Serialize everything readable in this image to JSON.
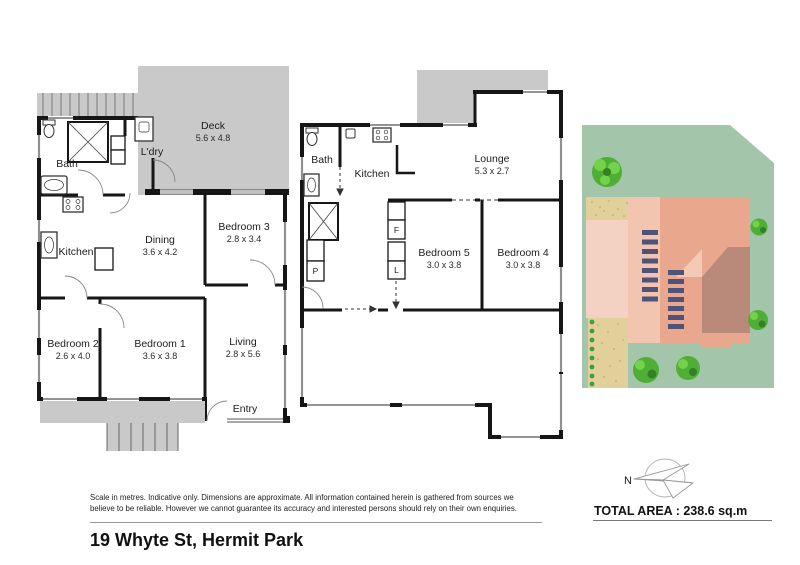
{
  "page": {
    "address": "19 Whyte St, Hermit Park",
    "disclaimer_line1": "Scale in metres. Indicative only. Dimensions are approximate. All information contained herein is gathered from sources we",
    "disclaimer_line2": "believe to be reliable. However we cannot guarantee its accuracy and interested persons should rely on their own enquiries.",
    "total_area": "TOTAL AREA : 238.6 sq.m",
    "compass": {
      "north_label": "N"
    }
  },
  "plan1": {
    "rooms": [
      {
        "name": "Deck",
        "dims": "5.6 x 4.8"
      },
      {
        "name": "Bath"
      },
      {
        "name": "L'dry"
      },
      {
        "name": "Kitchen"
      },
      {
        "name": "Dining",
        "dims": "3.6 x 4.2"
      },
      {
        "name": "Bedroom 3",
        "dims": "2.8 x 3.4"
      },
      {
        "name": "Bedroom 2",
        "dims": "2.6 x 4.0"
      },
      {
        "name": "Bedroom 1",
        "dims": "3.6 x 3.8"
      },
      {
        "name": "Living",
        "dims": "2.8 x 5.6"
      },
      {
        "name": "Entry"
      }
    ]
  },
  "plan2": {
    "rooms": [
      {
        "name": "Bath"
      },
      {
        "name": "Kitchen"
      },
      {
        "name": "Lounge",
        "dims": "5.3 x 2.7"
      },
      {
        "name": "Bedroom 5",
        "dims": "3.0 x 3.8"
      },
      {
        "name": "Bedroom 4",
        "dims": "3.0 x 3.8"
      }
    ],
    "labels": {
      "fridge": "F",
      "linen": "L",
      "pantry": "P"
    }
  },
  "colors": {
    "wall": "#161616",
    "deck_gray": "#c9c9c9",
    "grass": "#a3c6ab",
    "house_light": "#f1c5b0",
    "house_mid": "#e9a88d",
    "roof_dark": "#b98a7a",
    "gable_light": "#f4cab6",
    "sand": "#e2d09b",
    "path_pink": "#f3d2c4",
    "tree_green": "#4fae35",
    "tree_light": "#72d24a",
    "stair_slate": "#4e5377"
  }
}
